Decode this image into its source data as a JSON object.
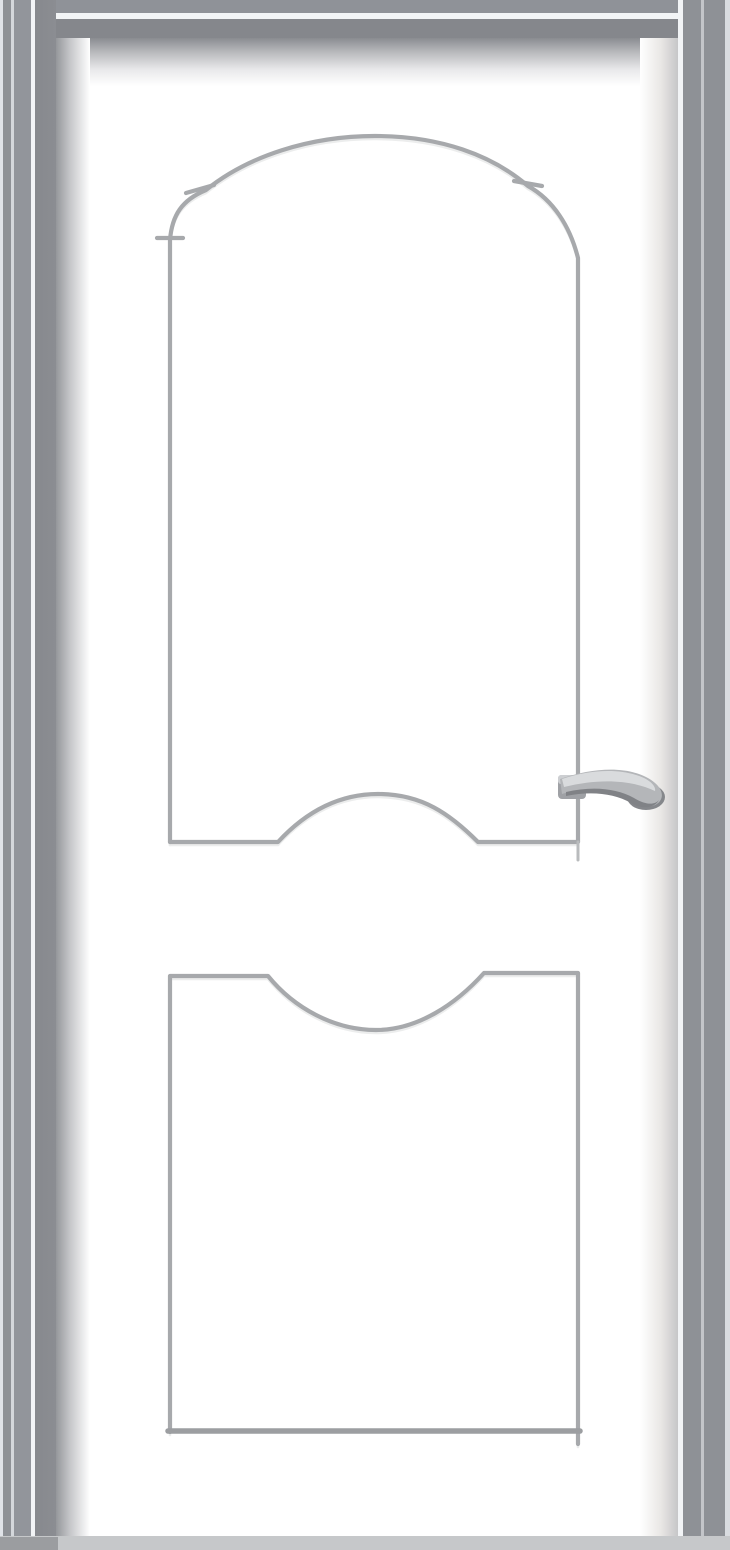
{
  "scene": {
    "type": "product-photo",
    "subject": "white interior panel door in a silver-gray metal frame",
    "elements": {
      "door_frame": "silver-gray metal jamb with bright highlight lines, visible on top, left and right",
      "door_leaf": "white slab with soft edge shadows",
      "upper_panel": "tall cathedral-arch moulded panel with notched shoulders and arched bottom rail",
      "lower_panel": "rectangular moulded panel with concave dipped top rail",
      "handle": "silver lever handle mounted on the right stile",
      "floor": "light gray floor strip at the bottom edge"
    },
    "text_content": "none (no visible text in image)"
  },
  "colors": {
    "door_white": "#ffffff",
    "frame_mid": "#8f9298",
    "frame_dark": "#85878c",
    "frame_highlight": "#f2f4f6",
    "frame_edge_light": "#e0e3e8",
    "leaf_shadow": "#95979b",
    "molding_gray": "#a7a9ac",
    "molding_highlight": "#eceded",
    "handle_mid": "#b4b6b9",
    "handle_dark": "#85878b",
    "handle_light": "#d9dbdd",
    "floor": "#c6c8ca"
  }
}
